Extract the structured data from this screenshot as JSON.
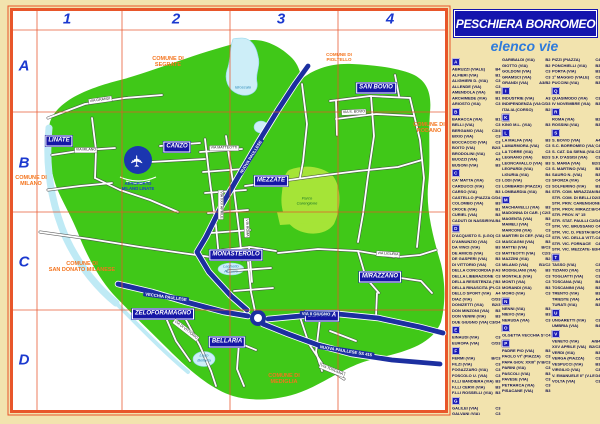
{
  "title": "PESCHIERA BORROMEO",
  "subtitle": "elenco vie",
  "colors": {
    "background_tan": "#f2e3ae",
    "frame_orange": "#e8562a",
    "grid_red": "#e8552b",
    "territory_green": "#40c818",
    "park_green": "#a5e437",
    "water_blue": "#cdeef8",
    "highway_blue": "#1c2fa0",
    "locality_box_blue": "#1616a6",
    "commune_orange": "#f4741d",
    "title_box_blue": "#1414ad",
    "subtitle_blue": "#2f7bdb",
    "grid_label_blue": "#1b39cf",
    "index_text_navy": "#101050"
  },
  "grid": {
    "columns": [
      "1",
      "2",
      "3",
      "4"
    ],
    "rows": [
      "A",
      "B",
      "C",
      "D"
    ]
  },
  "map": {
    "localities": [
      {
        "name": "LINATE",
        "x": 59,
        "y": 141
      },
      {
        "name": "CANZO",
        "x": 177,
        "y": 147
      },
      {
        "name": "MEZZATE",
        "x": 271,
        "y": 181
      },
      {
        "name": "SAN BOVIO",
        "x": 376,
        "y": 88
      },
      {
        "name": "MONASTEROLO",
        "x": 236,
        "y": 255
      },
      {
        "name": "ZELOFORAMAGNO",
        "x": 163,
        "y": 314
      },
      {
        "name": "BELLARIA",
        "x": 227,
        "y": 342
      },
      {
        "name": "BETTOLA",
        "x": 322,
        "y": 316
      },
      {
        "name": "MIRAZZANO",
        "x": 380,
        "y": 277
      }
    ],
    "communes": [
      {
        "t": "COMUNE DI\nSEGRATE",
        "x": 168,
        "y": 62,
        "small": false
      },
      {
        "t": "COMUNE DI\nPIOLTELLO",
        "x": 339,
        "y": 57,
        "small": true
      },
      {
        "t": "COMUNE DI\nMILANO",
        "x": 31,
        "y": 181,
        "small": false
      },
      {
        "t": "COMUNE DI\nRODANO",
        "x": 429,
        "y": 128,
        "small": false
      },
      {
        "t": "COMUNE DI\nSAN DONATO MILANESE",
        "x": 82,
        "y": 267,
        "small": false
      },
      {
        "t": "COMUNE DI\nMEDIGLIA",
        "x": 284,
        "y": 379,
        "small": false
      }
    ],
    "area_labels": [
      {
        "t": "Idroscalo",
        "x": 243,
        "y": 88,
        "cls": "lake"
      },
      {
        "t": "Laghetto\nAzzurro",
        "x": 231,
        "y": 269,
        "cls": "lake"
      },
      {
        "t": "Lago\nBellaria",
        "x": 204,
        "y": 358,
        "cls": "lake"
      },
      {
        "t": "Parco\nCarengione",
        "x": 307,
        "y": 201,
        "cls": "park"
      }
    ],
    "airport_caption": {
      "t": "AEROPORTO\nMILANO LINATE",
      "x": 138,
      "y": 186
    },
    "road_labels": [
      {
        "t": "VIA GRANDI",
        "x": 100,
        "y": 100,
        "r": -8,
        "type": "st"
      },
      {
        "t": "VIA MILANO",
        "x": 86,
        "y": 150,
        "r": 0,
        "type": "st"
      },
      {
        "t": "VIA XXV APRILE",
        "x": 221,
        "y": 205,
        "r": 90,
        "type": "st"
      },
      {
        "t": "VIA MATTEOTTI",
        "x": 224,
        "y": 148,
        "r": 0,
        "type": "st"
      },
      {
        "t": "VIA DI VITTORIO",
        "x": 186,
        "y": 330,
        "r": 38,
        "type": "st"
      },
      {
        "t": "VIA S. BOVIO",
        "x": 354,
        "y": 112,
        "r": -2,
        "type": "st"
      },
      {
        "t": "VIA LIGURIA",
        "x": 388,
        "y": 254,
        "r": 4,
        "type": "st"
      },
      {
        "t": "VIA TOSCANA",
        "x": 332,
        "y": 370,
        "r": 22,
        "type": "st"
      },
      {
        "t": "VIA ROMA",
        "x": 247,
        "y": 228,
        "r": 88,
        "type": "st"
      },
      {
        "t": "NUOVA PAULLESE",
        "x": 251,
        "y": 157,
        "r": -58,
        "type": "hwy"
      },
      {
        "t": "VECCHIA PAULLESE",
        "x": 166,
        "y": 297,
        "r": 8,
        "type": "hwy"
      },
      {
        "t": "VIA II GIUGNO",
        "x": 316,
        "y": 314,
        "r": 1,
        "type": "hwy"
      },
      {
        "t": "NUOVA PAULLESE SS 415",
        "x": 346,
        "y": 351,
        "r": 9,
        "type": "hwy"
      }
    ]
  },
  "index": {
    "columns": [
      [
        {
          "letter": "A",
          "entries": [
            [
              "ABRUZZI (VIALE)",
              "B4"
            ],
            [
              "ALFIERI (VIA)",
              "B1"
            ],
            [
              "ALIGHIERI D. (VIA)",
              "C3"
            ],
            [
              "ALLENDE (VIA)",
              "C3"
            ],
            [
              "AMENDOLA (VIA)",
              "B3"
            ],
            [
              "ARCHIMEDE (VIA)",
              "B1"
            ],
            [
              "ARIOSTO (VIA)",
              "C3"
            ]
          ]
        },
        {
          "letter": "B",
          "entries": [
            [
              "BARACCA (VIA)",
              "B1"
            ],
            [
              "BELLI (VIA)",
              "C3"
            ],
            [
              "BERGAMO (VIA)",
              "C3/4"
            ],
            [
              "BIXIO (VIA)",
              "C3"
            ],
            [
              "BOCCACCIO (VIA)",
              "C3"
            ],
            [
              "BOITO (VIA)",
              "B2/3"
            ],
            [
              "BRODOLINI (VIA)",
              "C3"
            ],
            [
              "BUOZZI (VIA)",
              "A3"
            ],
            [
              "BUSONI (VIA)",
              "B3"
            ]
          ]
        },
        {
          "letter": "C",
          "entries": [
            [
              "CA' MATTA (VIA)",
              "C3"
            ],
            [
              "CARDUCCI (VIA)",
              "C3"
            ],
            [
              "CARSO (VIA)",
              "B3"
            ],
            [
              "CASTELLO (PIAZZA)",
              "C/D4"
            ],
            [
              "COLOMBO (VIA)",
              "B3"
            ],
            [
              "CROCE (VIA)",
              "B1"
            ],
            [
              "CURIEL (VIA)",
              "B3"
            ],
            [
              "CADUTI DI NASSIRIYA (VIA)",
              "B4"
            ]
          ]
        },
        {
          "letter": "D",
          "entries": [
            [
              "D'ACQUISTO S. (LGO)",
              "C3"
            ],
            [
              "D'ANNUNZIO (VIA)",
              "C3"
            ],
            [
              "DA VINCI (VIA)",
              "B3"
            ],
            [
              "DE AMICIS (VIA)",
              "C3"
            ],
            [
              "DE GASPERI (VIA)",
              "B3"
            ],
            [
              "DI VITTORIO (VIA)",
              "C3"
            ],
            [
              "DELLA CONCORDIA (PIAZZA)",
              "A3"
            ],
            [
              "DELLA LIBERAZIONE (VIA)",
              "C3"
            ],
            [
              "DELLA RESISTENZA (VIA)",
              "B3"
            ],
            [
              "DELLA RINASCITA (PIAZZA)",
              "C3"
            ],
            [
              "DELLO SPORT (VIA)",
              "A4"
            ],
            [
              "DIAZ (VIA)",
              "C/D3"
            ],
            [
              "DONIZETTI (VIA)",
              "B2/3"
            ],
            [
              "DON MINZONI (VIA)",
              "B3"
            ],
            [
              "DON VENINI (VIA)",
              "B3"
            ],
            [
              "DUE GIUGNO (VIA)",
              "C3/D4"
            ]
          ]
        },
        {
          "letter": "E",
          "entries": [
            [
              "EINAUDI (VIA)",
              "C3"
            ],
            [
              "EUROPA (VIA)",
              "C/D3"
            ]
          ]
        },
        {
          "letter": "F",
          "entries": [
            [
              "FERMI (VIA)",
              "B/C3"
            ],
            [
              "FILZI (VIA)",
              "C3"
            ],
            [
              "FOGAZZARO (VIA)",
              "C3"
            ],
            [
              "FOSCOLO U. (VIA)",
              "C3"
            ],
            [
              "F.LLI BANDIERA (VIA)",
              "B3"
            ],
            [
              "F.LLI CERVI (VIA)",
              "B3"
            ],
            [
              "F.LLI ROSSELLI (VIA)",
              "B3"
            ]
          ]
        },
        {
          "letter": "G",
          "entries": [
            [
              "GALILEI (VIA)",
              "C3"
            ],
            [
              "GALVANI (VIA)",
              "C3"
            ]
          ]
        }
      ],
      [
        {
          "letter": "",
          "entries": [
            [
              "GARIBALDI (VIA)",
              "B2"
            ],
            [
              "GIOTTO (VIA)",
              "B2"
            ],
            [
              "GOLDONI (VIA)",
              "C3"
            ],
            [
              "GRAMSCI (VIA)",
              "C3"
            ],
            [
              "GRANDI (VIA)",
              "A3/B2"
            ]
          ]
        },
        {
          "letter": "I",
          "entries": [
            [
              "INDUSTRIE (VIA)",
              "A3"
            ],
            [
              "INDIPENDENZA (VIA)",
              "C/D3"
            ],
            [
              "ITALIA (CORSO)",
              "B2"
            ]
          ]
        },
        {
          "letter": "K",
          "entries": [
            [
              "KING M.L. (VIA)",
              "B3"
            ]
          ]
        },
        {
          "letter": "L",
          "entries": [
            [
              "LA MALFA (VIA)",
              "B3"
            ],
            [
              "LAMARMORA (VIA)",
              "C3"
            ],
            [
              "LA TORRE (VIA)",
              "C3"
            ],
            [
              "LEGNANO (VIA)",
              "B2/3"
            ],
            [
              "LEONCAVALLO (VIA)",
              "B3"
            ],
            [
              "LEOPARDI (VIA)",
              "C3"
            ],
            [
              "LIGURIA (VIA)",
              "B4"
            ],
            [
              "LODI (VIA)",
              "C3"
            ],
            [
              "LOMBARDI (PIAZZA)",
              "C3"
            ],
            [
              "LOMBARDIA (VIA)",
              "B4"
            ]
          ]
        },
        {
          "letter": "M",
          "entries": [
            [
              "MACHIAVELLI (VIA)",
              "B3"
            ],
            [
              "MADONNA DI CAR. (VIA)",
              "C2/3"
            ],
            [
              "MAGENTA (VIA)",
              "B3"
            ],
            [
              "MAMELI (VIA)",
              "C3"
            ],
            [
              "MARCONI (VIA)",
              "C3"
            ],
            [
              "MARTIRI DI CEF. (VIA)",
              "C3"
            ],
            [
              "MASCAGNI (VIA)",
              "B3"
            ],
            [
              "MATTEI (VIA)",
              "B/C3"
            ],
            [
              "MATTEOTTI (VIA)",
              "C2/3"
            ],
            [
              "MAZZINI (VIA)",
              "B2"
            ],
            [
              "MILANO (VIA)",
              "B1/C2"
            ],
            [
              "MODIGLIANI (VIA)",
              "B3"
            ],
            [
              "MONTALE (VIA)",
              "C3"
            ],
            [
              "MONTI (VIA)",
              "C3"
            ],
            [
              "MORANDI (VIA)",
              "B3"
            ],
            [
              "MORO (VIA)",
              "C3"
            ]
          ]
        },
        {
          "letter": "N",
          "entries": [
            [
              "NENNI (VIA)",
              "B3"
            ],
            [
              "NIEVO (VIA)",
              "B3"
            ],
            [
              "NERUDA (VIA)",
              "C3"
            ]
          ]
        },
        {
          "letter": "O",
          "entries": [
            [
              "OLGETTA VECCHIA STRADA",
              "C4"
            ]
          ]
        },
        {
          "letter": "P",
          "entries": [
            [
              "PADRE PIO (VIA)",
              "B3"
            ],
            [
              "PAOLO VI° (PIAZZA)",
              "C3"
            ],
            [
              "PAPA GIOV. XXIII° (V.LE)",
              "B/C3"
            ],
            [
              "PARINI (VIA)",
              "C3"
            ],
            [
              "PASCOLI (VIA)",
              "B3"
            ],
            [
              "PAVESE (VIA)",
              "C3"
            ],
            [
              "PETRARCA (VIA)",
              "C3"
            ],
            [
              "PISACANE (VIA)",
              "B3"
            ]
          ]
        }
      ],
      [
        {
          "letter": "",
          "entries": [
            [
              "PIZZI (PIAZZA)",
              "C4"
            ],
            [
              "PONCHIELLI (VIA)",
              "B3"
            ],
            [
              "PORTA (VIA)",
              "B3"
            ],
            [
              "1° MAGGIO (VIALE)",
              "C3"
            ],
            [
              "PUCCINI (VIA)",
              "B3"
            ]
          ]
        },
        {
          "letter": "Q",
          "entries": [
            [
              "QUASIMODO (VIA)",
              "C3"
            ],
            [
              "IV NOVEMBRE (VIA)",
              "B3"
            ]
          ]
        },
        {
          "letter": "R",
          "entries": [
            [
              "ROMA (VIA)",
              "B2"
            ],
            [
              "ROSSINI (VIA)",
              "B3"
            ]
          ]
        },
        {
          "letter": "S",
          "entries": [
            [
              "S. BOVIO (VIA)",
              "A4"
            ],
            [
              "S.C. BORROMEO (VIA)",
              "C4"
            ],
            [
              "S. CAT. DA SIENA (VIA)",
              "C3"
            ],
            [
              "S.F. D'ASSISI (VIA)",
              "C3"
            ],
            [
              "S. MARIA (VIA)",
              "B2/3"
            ],
            [
              "S. MARTINO (VIA)",
              "B3"
            ],
            [
              "SAURO N. (VIA)",
              "B3"
            ],
            [
              "SFORZA (VIA)",
              "C4"
            ],
            [
              "SOLFERINO (VIA)",
              "B3"
            ],
            [
              "STR. COM. MIRAZZANO",
              "B4"
            ],
            [
              "STR. COM. DI BELLARIA",
              "D2/3"
            ],
            [
              "STR. PRIV. CARENGIONE",
              ""
            ],
            [
              "STR. PROV. MIRAZZ.-VIM.",
              "B/C4"
            ],
            [
              "STR. PROV. N° 15",
              ""
            ],
            [
              "STR. STAT. PAULLESE",
              "C2/D4"
            ],
            [
              "STR. VIC. BRUSSANO",
              "C4"
            ],
            [
              "STR. VIC. D. PESTAGNA",
              "B/C4"
            ],
            [
              "STR. VIC. DELLA VITTA",
              "C4"
            ],
            [
              "STR. VIC. FORNACE",
              "C4"
            ],
            [
              "STR. VIC. MEZZATE-FOR.",
              "B3/4"
            ]
          ]
        },
        {
          "letter": "T",
          "entries": [
            [
              "TASSO (VIA)",
              "C3"
            ],
            [
              "TIZIANO (VIA)",
              "C3"
            ],
            [
              "TOGLIATTI (VIA)",
              "C3"
            ],
            [
              "TOSCANA (VIA)",
              "B4"
            ],
            [
              "TOSCANINI (VIA)",
              "B3"
            ],
            [
              "TRENTO (VIA)",
              "B3"
            ],
            [
              "TRIESTE (VIA)",
              "A4"
            ],
            [
              "TURATI (VIA)",
              "B3"
            ]
          ]
        },
        {
          "letter": "U",
          "entries": [
            [
              "UNGARETTI (VIA)",
              "C3"
            ],
            [
              "UMBRIA (VIA)",
              "B4"
            ]
          ]
        },
        {
          "letter": "V",
          "entries": [
            [
              "VENETO (VIA)",
              "A/B4"
            ],
            [
              "XXV APRILE (VIA)",
              "B2/C3"
            ],
            [
              "VERDI (VIA)",
              "B3"
            ],
            [
              "VERGA (PIAZZA)",
              "C3"
            ],
            [
              "VESPUCCI (VIA)",
              "B3"
            ],
            [
              "VIRGILIO (VIA)",
              "C3"
            ],
            [
              "V. EMANUELE II° (V.LE)",
              "D4"
            ],
            [
              "VOLTA (VIA)",
              "C3"
            ]
          ]
        }
      ]
    ]
  }
}
